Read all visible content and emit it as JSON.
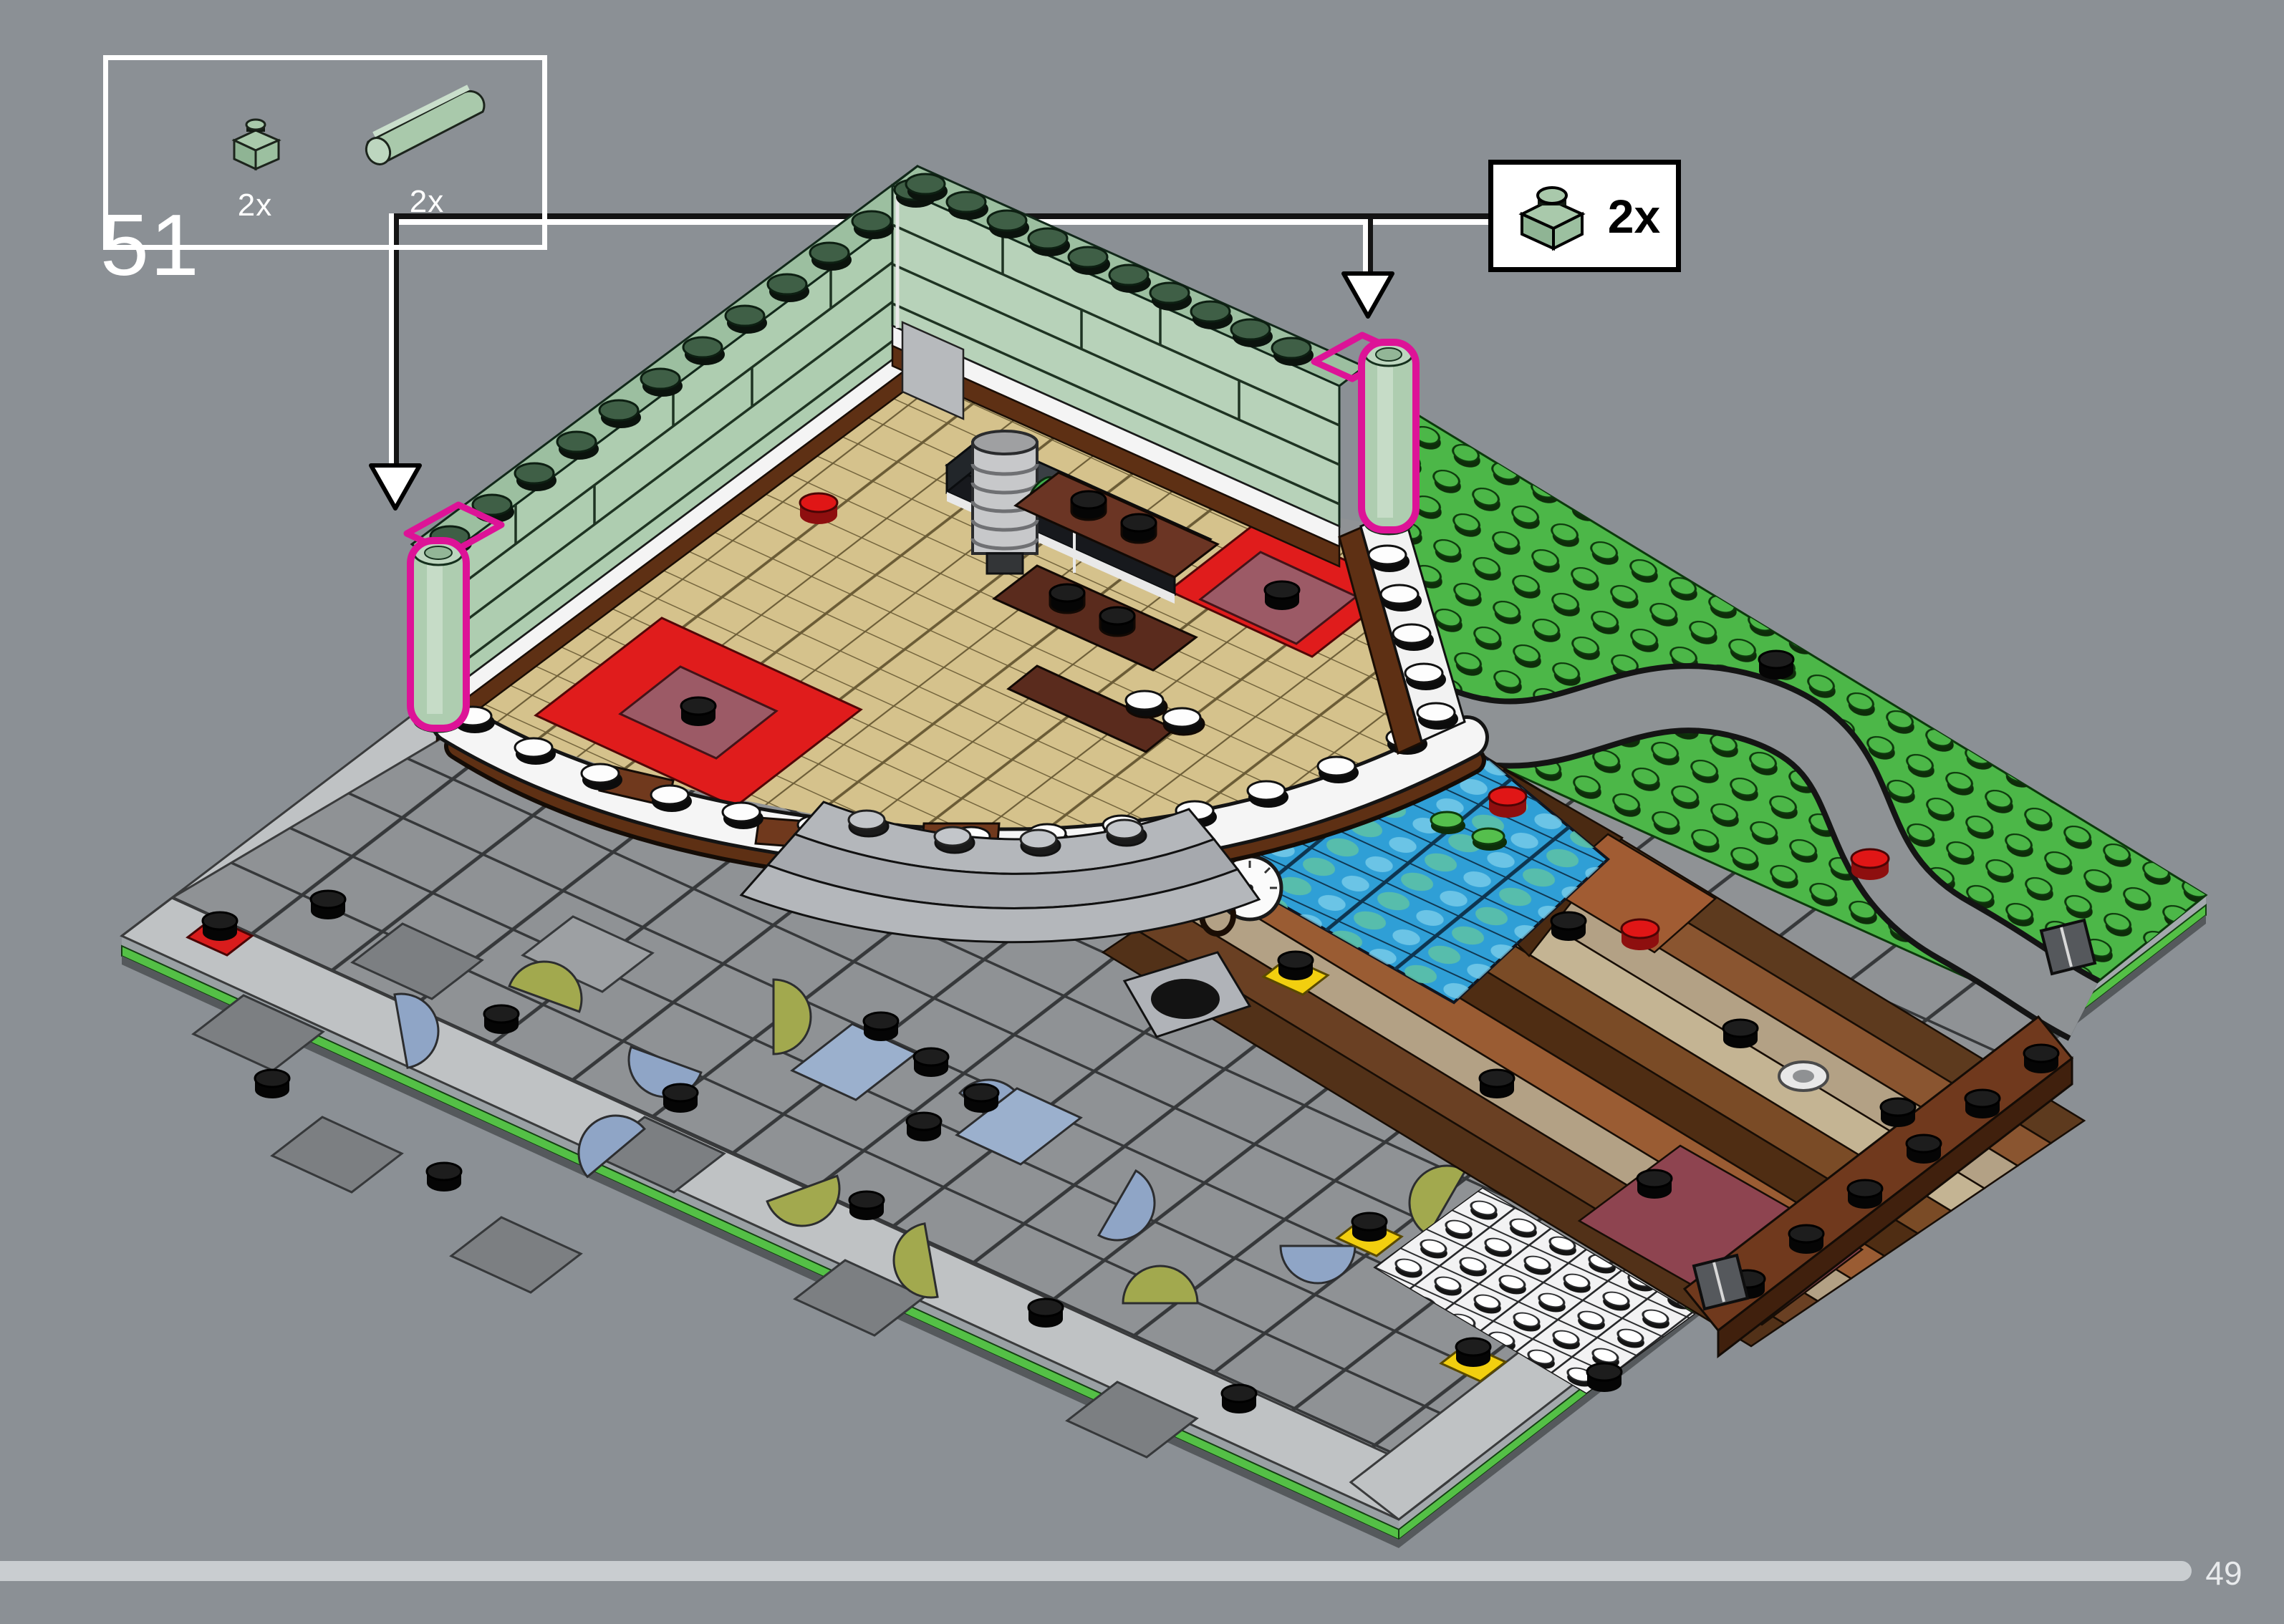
{
  "page": {
    "step_number": "51",
    "number": "49",
    "background_color": "#8b9095"
  },
  "parts_box": {
    "parts": [
      {
        "name": "plate-1x1",
        "color_name": "sand-green",
        "color": "#a9c9ab",
        "qty": "2x"
      },
      {
        "name": "round-cylinder-tube",
        "color_name": "sand-green",
        "color": "#a9c9ab",
        "qty": "2x"
      }
    ]
  },
  "callout": {
    "part": "plate-1x1",
    "color_name": "sand-green",
    "color": "#a9c9ab",
    "qty": "2x",
    "box_color": "#ffffff",
    "border_color": "#000000"
  },
  "build": {
    "description": "isometric baseplate assembly with sand-green corner walls, tan parquet platform, red carpets, pond, wooden floor, grass baseplate and stone plaza",
    "highlight_color": "#dd1397",
    "wall_color": "#aecdb0",
    "grass_color": "#4cb748",
    "plaza_color": "#8f9295",
    "parquet_color": "#d5c28c",
    "pond_color": "#2f9fd6",
    "carpet_color": "#e01c1c",
    "baseplate_stripe_color": "#54c046"
  },
  "progress": {
    "bar_color": "#c9cdd0"
  }
}
